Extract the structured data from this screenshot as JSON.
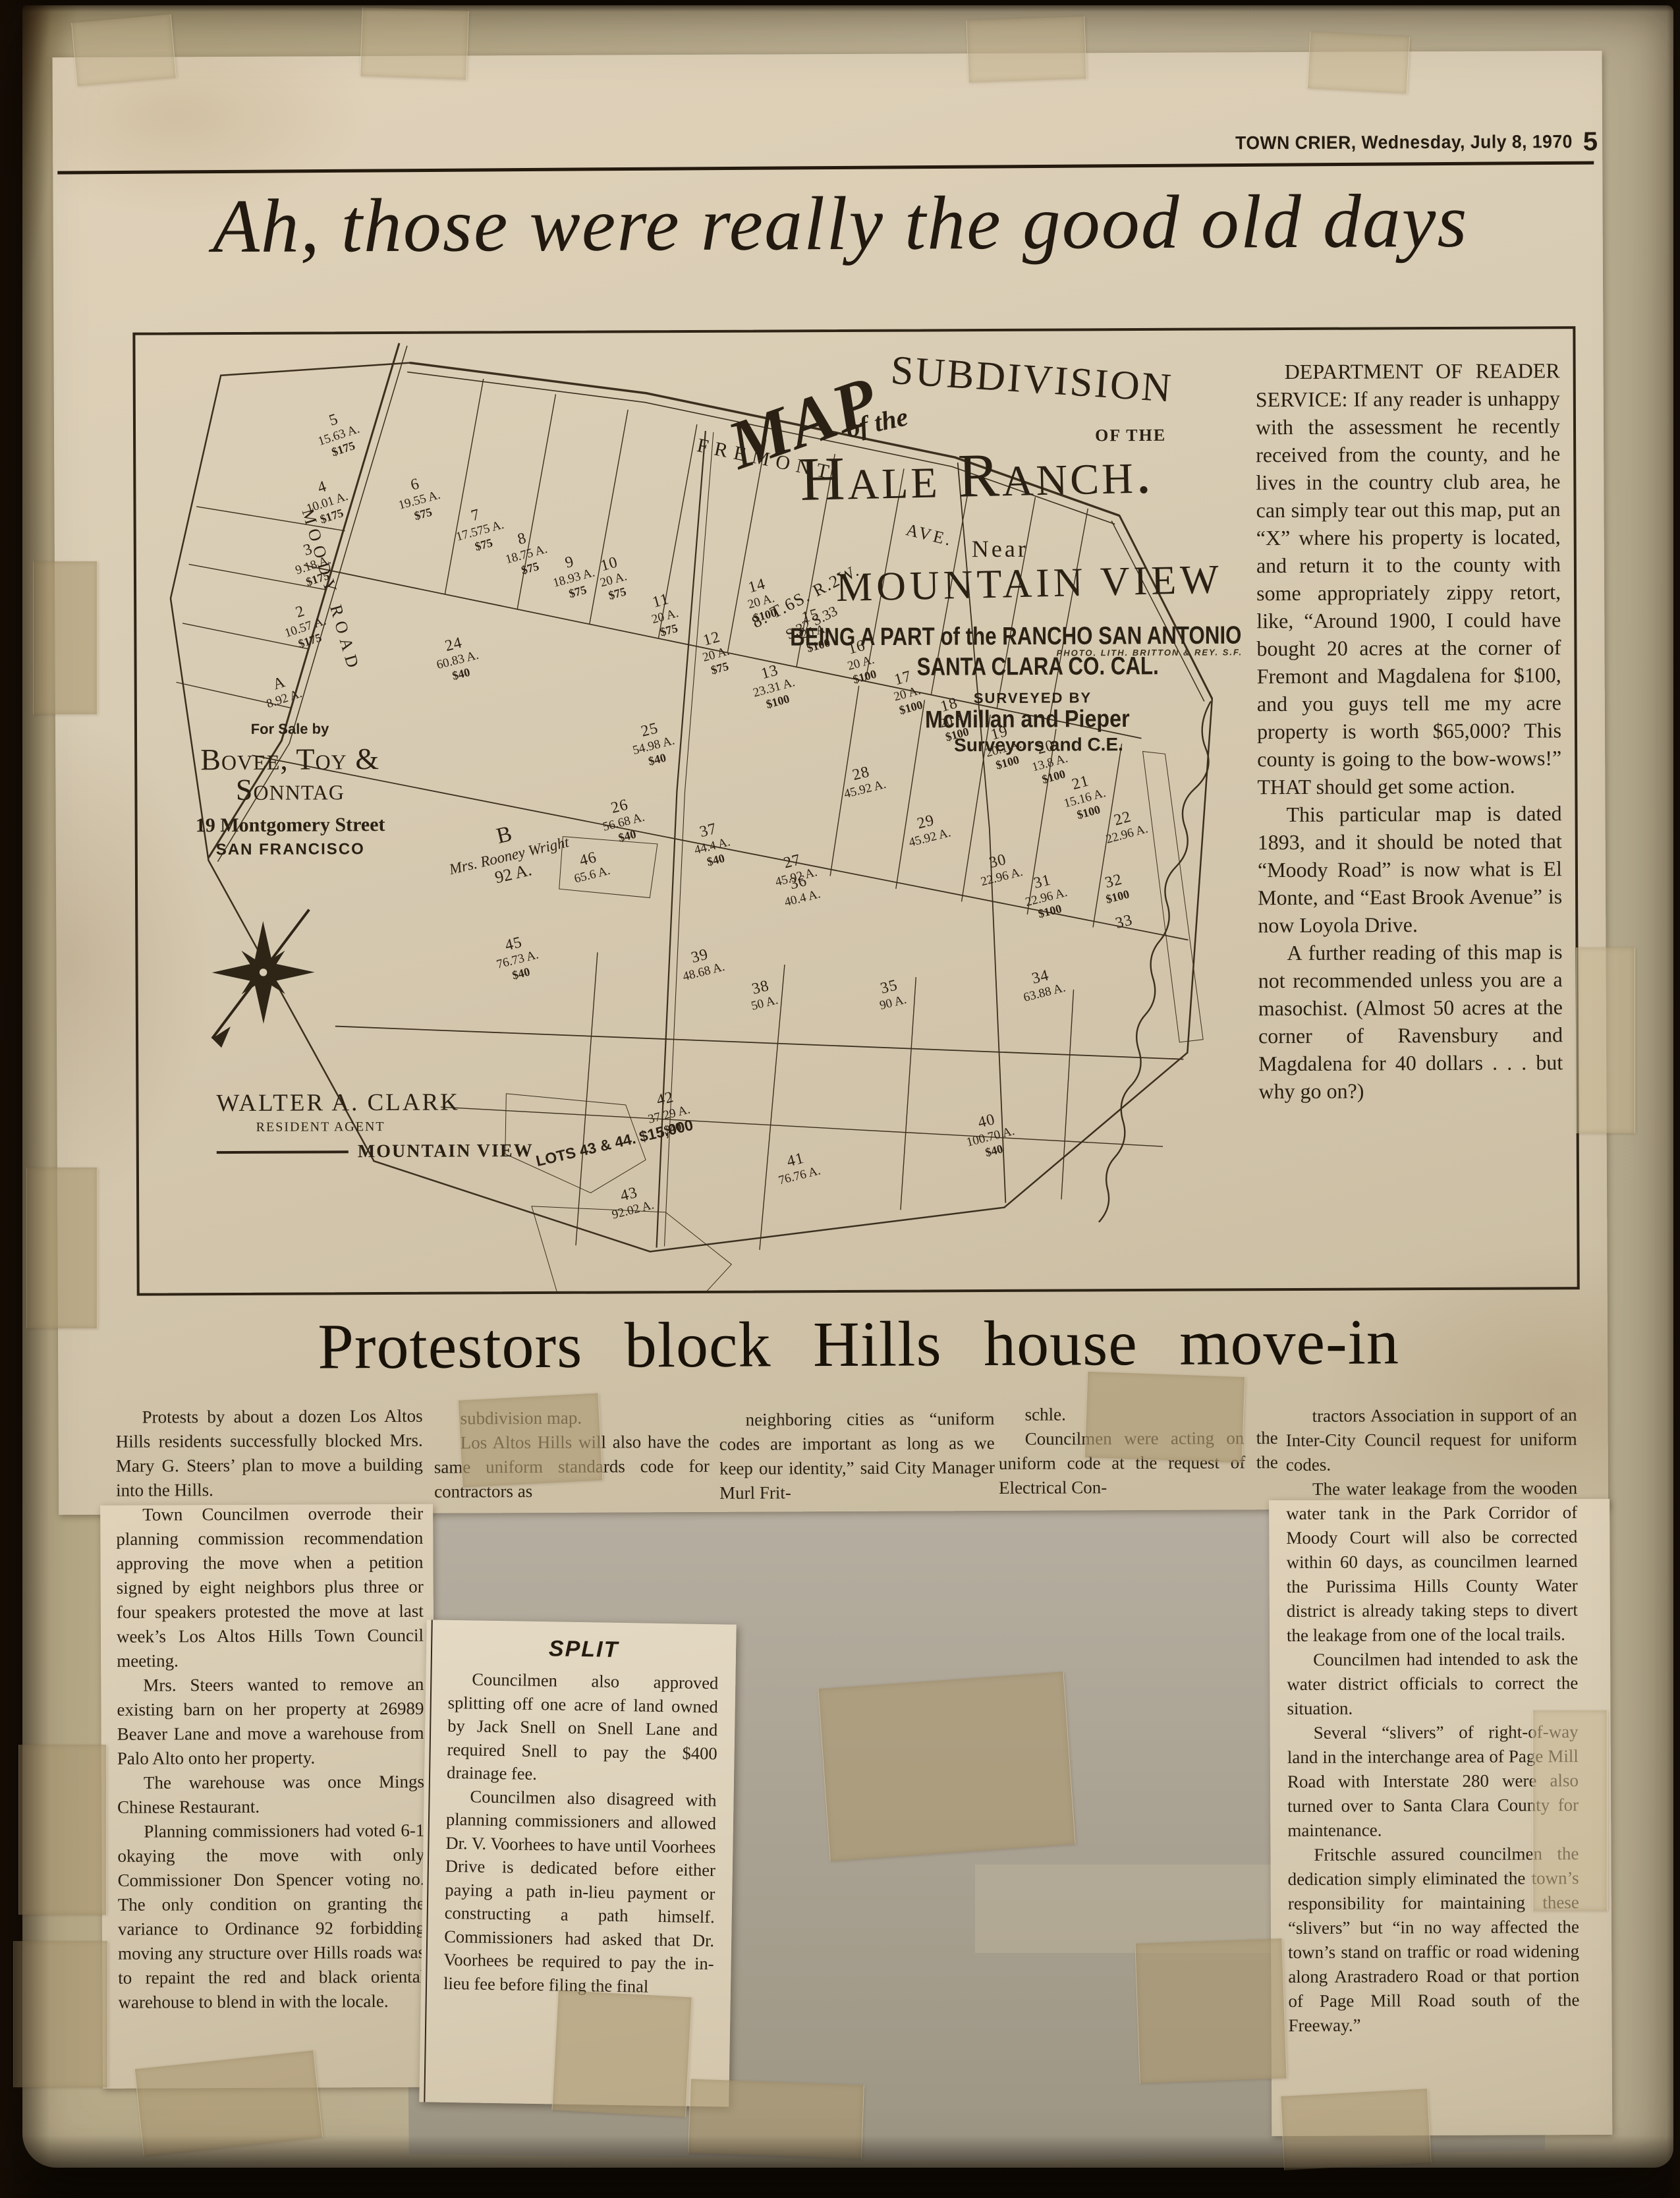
{
  "masthead": {
    "title": "TOWN CRIER, Wednesday, July 8, 1970",
    "page_number": "5"
  },
  "main_headline": "Ah, those were really the good old days",
  "map": {
    "title_map": "MAP",
    "title_ofthe": "of the",
    "title_subdivision": "SUBDIVISION",
    "title_ofthe2": "OF THE",
    "title_hale": "Hale Ranch.",
    "near": "Near",
    "mountain_view": "MOUNTAIN VIEW",
    "being": "BEING A PART of the RANCHO SAN ANTONIO",
    "santa_clara": "SANTA CLARA CO. CAL.",
    "surveyed_by": "SURVEYED BY",
    "surveyors_name": "McMillan and Pieper",
    "surveyors_title": "Surveyors and C.E.",
    "photo_credit": "PHOTO. LITH. BRITTON & REY. S.F.",
    "township": "8. T.6S. R.2W.",
    "sections": "S.32  S.33",
    "road_fremont": "FREMONT",
    "road_fremont_ave": "AVE.",
    "road_moody": "MOODY ROAD",
    "for_sale_by": "For Sale by",
    "firm": "Bovee, Toy & Sonntag",
    "address": "19 Montgomery Street",
    "city": "SAN FRANCISCO",
    "agent_name": "WALTER A. CLARK",
    "agent_title": "RESIDENT AGENT",
    "agent_city": "MOUNTAIN VIEW",
    "parcel_b_id": "B",
    "parcel_b_owner": "Mrs. Rooney Wright",
    "parcel_b_acres": "92 A.",
    "lots_note": "LOTS 43 & 44.  $15,000",
    "lots": [
      {
        "id": "5",
        "acres": "15.63 A.",
        "price": "$175",
        "x": 12.6,
        "y": 8.0,
        "rot": -18
      },
      {
        "id": "4",
        "acres": "10.01 A.",
        "price": "$175",
        "x": 11.8,
        "y": 15.0,
        "rot": -18
      },
      {
        "id": "3",
        "acres": "9.18 A.",
        "price": "$175",
        "x": 11.0,
        "y": 21.5,
        "rot": -18
      },
      {
        "id": "2",
        "acres": "10.57 A.",
        "price": "$175",
        "x": 10.2,
        "y": 28.0,
        "rot": -18
      },
      {
        "id": "A",
        "acres": "8.92 A.",
        "price": "",
        "x": 8.8,
        "y": 35.5,
        "rot": -18
      },
      {
        "id": "6",
        "acres": "19.55 A.",
        "price": "$75",
        "x": 18.2,
        "y": 14.8,
        "rot": -15
      },
      {
        "id": "7",
        "acres": "17.575 A.",
        "price": "$75",
        "x": 22.2,
        "y": 18.0,
        "rot": -15
      },
      {
        "id": "8",
        "acres": "18.75 A.",
        "price": "$75",
        "x": 25.6,
        "y": 20.5,
        "rot": -15
      },
      {
        "id": "9",
        "acres": "18.93 A.",
        "price": "$75",
        "x": 28.9,
        "y": 23.0,
        "rot": -15
      },
      {
        "id": "10",
        "acres": "20 A.",
        "price": "$75",
        "x": 32.2,
        "y": 23.2,
        "rot": -15
      },
      {
        "id": "11",
        "acres": "20 A.",
        "price": "$75",
        "x": 35.8,
        "y": 27.0,
        "rot": -15
      },
      {
        "id": "12",
        "acres": "20 A.",
        "price": "$75",
        "x": 39.3,
        "y": 31.0,
        "rot": -15
      },
      {
        "id": "13",
        "acres": "23.31 A.",
        "price": "$100",
        "x": 42.8,
        "y": 34.5,
        "rot": -15
      },
      {
        "id": "14",
        "acres": "20 A.",
        "price": "$100",
        "x": 42.5,
        "y": 25.5,
        "rot": -15
      },
      {
        "id": "15",
        "acres": "20 A.",
        "price": "$100",
        "x": 46.2,
        "y": 28.7,
        "rot": -15
      },
      {
        "id": "16",
        "acres": "20 A.",
        "price": "$100",
        "x": 49.4,
        "y": 32.0,
        "rot": -15
      },
      {
        "id": "17",
        "acres": "20 A.",
        "price": "$100",
        "x": 52.6,
        "y": 35.2,
        "rot": -15
      },
      {
        "id": "18",
        "acres": "20 A.",
        "price": "$100",
        "x": 55.8,
        "y": 38.0,
        "rot": -15
      },
      {
        "id": "19",
        "acres": "20.1 A.",
        "price": "$100",
        "x": 59.0,
        "y": 41.0,
        "rot": -15
      },
      {
        "id": "20",
        "acres": "13.8 A.",
        "price": "$100",
        "x": 62.2,
        "y": 42.5,
        "rot": -15
      },
      {
        "id": "21",
        "acres": "15.16 A.",
        "price": "$100",
        "x": 64.4,
        "y": 46.2,
        "rot": -15
      },
      {
        "id": "22",
        "acres": "22.96 A.",
        "price": "",
        "x": 67.2,
        "y": 50.0,
        "rot": -15
      },
      {
        "id": "24",
        "acres": "60.83 A.",
        "price": "$40",
        "x": 20.8,
        "y": 31.5,
        "rot": -14
      },
      {
        "id": "25",
        "acres": "54.98 A.",
        "price": "$40",
        "x": 34.4,
        "y": 40.5,
        "rot": -14
      },
      {
        "id": "26",
        "acres": "56.68 A.",
        "price": "$40",
        "x": 32.3,
        "y": 48.5,
        "rot": -14
      },
      {
        "id": "27",
        "acres": "45.92 A.",
        "price": "",
        "x": 44.2,
        "y": 54.3,
        "rot": -14
      },
      {
        "id": "28",
        "acres": "45.92 A.",
        "price": "",
        "x": 49.0,
        "y": 45.2,
        "rot": -14
      },
      {
        "id": "29",
        "acres": "45.92 A.",
        "price": "",
        "x": 53.5,
        "y": 50.3,
        "rot": -14
      },
      {
        "id": "30",
        "acres": "22.96 A.",
        "price": "",
        "x": 58.5,
        "y": 54.4,
        "rot": -14
      },
      {
        "id": "31",
        "acres": "22.96 A.",
        "price": "$100",
        "x": 61.7,
        "y": 56.5,
        "rot": -14
      },
      {
        "id": "32",
        "acres": "",
        "price": "$100",
        "x": 67.2,
        "y": 56.5,
        "rot": -14
      },
      {
        "id": "33",
        "acres": "",
        "price": "",
        "x": 68.0,
        "y": 60.8,
        "rot": -14
      },
      {
        "id": "37",
        "acres": "44.4 A.",
        "price": "$40",
        "x": 38.7,
        "y": 51.0,
        "rot": -14
      },
      {
        "id": "36",
        "acres": "40.4 A.",
        "price": "",
        "x": 44.8,
        "y": 56.5,
        "rot": -14
      },
      {
        "id": "46",
        "acres": "65.6 A.",
        "price": "",
        "x": 30.2,
        "y": 54.0,
        "rot": -14
      },
      {
        "id": "45",
        "acres": "76.73 A.",
        "price": "$40",
        "x": 24.9,
        "y": 62.8,
        "rot": -14
      },
      {
        "id": "39",
        "acres": "48.68 A.",
        "price": "",
        "x": 37.7,
        "y": 64.2,
        "rot": -14
      },
      {
        "id": "38",
        "acres": "50 A.",
        "price": "",
        "x": 42.5,
        "y": 67.5,
        "rot": -14
      },
      {
        "id": "35",
        "acres": "90 A.",
        "price": "",
        "x": 51.4,
        "y": 67.5,
        "rot": -14
      },
      {
        "id": "34",
        "acres": "63.88 A.",
        "price": "",
        "x": 61.4,
        "y": 66.5,
        "rot": -14
      },
      {
        "id": "40",
        "acres": "100.70 A.",
        "price": "$40",
        "x": 57.5,
        "y": 81.5,
        "rot": -14
      },
      {
        "id": "41",
        "acres": "76.76 A.",
        "price": "",
        "x": 44.3,
        "y": 85.5,
        "rot": -14
      },
      {
        "id": "42",
        "acres": "37.29 A.",
        "price": "$40",
        "x": 35.4,
        "y": 79.0,
        "rot": -14
      },
      {
        "id": "43",
        "acres": "92.02 A.",
        "price": "",
        "x": 32.7,
        "y": 89.0,
        "rot": -14
      }
    ]
  },
  "reader_service": {
    "paragraphs": [
      "DEPARTMENT OF READER SERVICE: If any reader is unhappy with the assessment he recently received from the county, and he lives in the country club area, he can simply tear out this map, put an “X” where his property is located, and return it to the county with some appropriately zippy retort, like, “Around 1900, I could have bought 20 acres at the corner of Fremont and Magdalena for $100, and you guys tell me my acre property is worth $65,000? This county is going to the bow-wows!” THAT should get some action.",
      "This particular map is dated 1893, and it should be noted that “Moody Road” is now what is El Monte, and “East Brook Avenue” is now Loyola Drive.",
      "A further reading of this map is not recommended unless you are a masochist. (Almost 50 acres at the corner of Ravensbury and Magdalena for 40 dollars . . . but why go on?)"
    ]
  },
  "protest": {
    "headline": "Protestors block Hills house move-in",
    "col1": [
      "Protests by about a dozen Los Altos Hills residents successfully blocked Mrs. Mary G. Steers’ plan to move a building into the Hills.",
      "Town Councilmen overrode their planning commission recommendation approving the move when a petition signed by eight neighbors plus three or four speakers protested the move at last week’s Los Altos Hills Town Council meeting.",
      "Mrs. Steers wanted to remove an existing barn on her property at 26989 Beaver Lane and move a warehouse from Palo Alto onto her property.",
      "The warehouse was once Mings Chinese Restaurant.",
      "Planning commissioners had voted 6-1 okaying the move with only Commissioner Don Spencer voting no. The only condition on granting the variance to Ordinance 92 forbidding moving any structure over Hills roads was to repaint the red and black oriental warehouse to blend in with the locale."
    ],
    "col2": [
      "subdivision map.",
      "Los Altos Hills will also have the same uniform standards code for contractors as"
    ],
    "col3": [
      "neighboring cities as “uniform codes are important as long as we keep our identity,” said City Manager Murl Frit-"
    ],
    "col4": [
      "schle.",
      "Councilmen were acting on the uniform code at the request of the Electrical Con-"
    ],
    "col5": [
      "tractors Association in support of an Inter-City Council request for uniform codes.",
      "The water leakage from the wooden water tank in the Park Corridor of Moody Court will also be corrected within 60 days, as councilmen learned the Purissima Hills County Water district is already taking steps to divert the leakage from one of the local trails.",
      "Councilmen had intended to ask the water district officials to correct the situation.",
      "Several “slivers” of right-of-way land in the interchange area of Page Mill Road with Interstate 280 were also turned over to Santa Clara County for maintenance.",
      "Fritschle assured councilmen the dedication simply eliminated the town’s responsibility for maintaining these “slivers” but “in no way affected the town’s stand on traffic or road widening along Arastradero Road or that portion of Page Mill Road south of the Freeway.”"
    ]
  },
  "split_box": {
    "title": "SPLIT",
    "paragraphs": [
      "Councilmen also approved splitting off one acre of land owned by Jack Snell on Snell Lane and required Snell to pay the $400 drainage fee.",
      "Councilmen also disagreed with planning commissioners and allowed Dr. V. Voorhees to have until Voorhees Drive is dedicated before either paying a path in-lieu payment or constructing a path himself. Commissioners had asked that Dr. Voorhees be required to pay the in-lieu fee before filing the final"
    ]
  }
}
